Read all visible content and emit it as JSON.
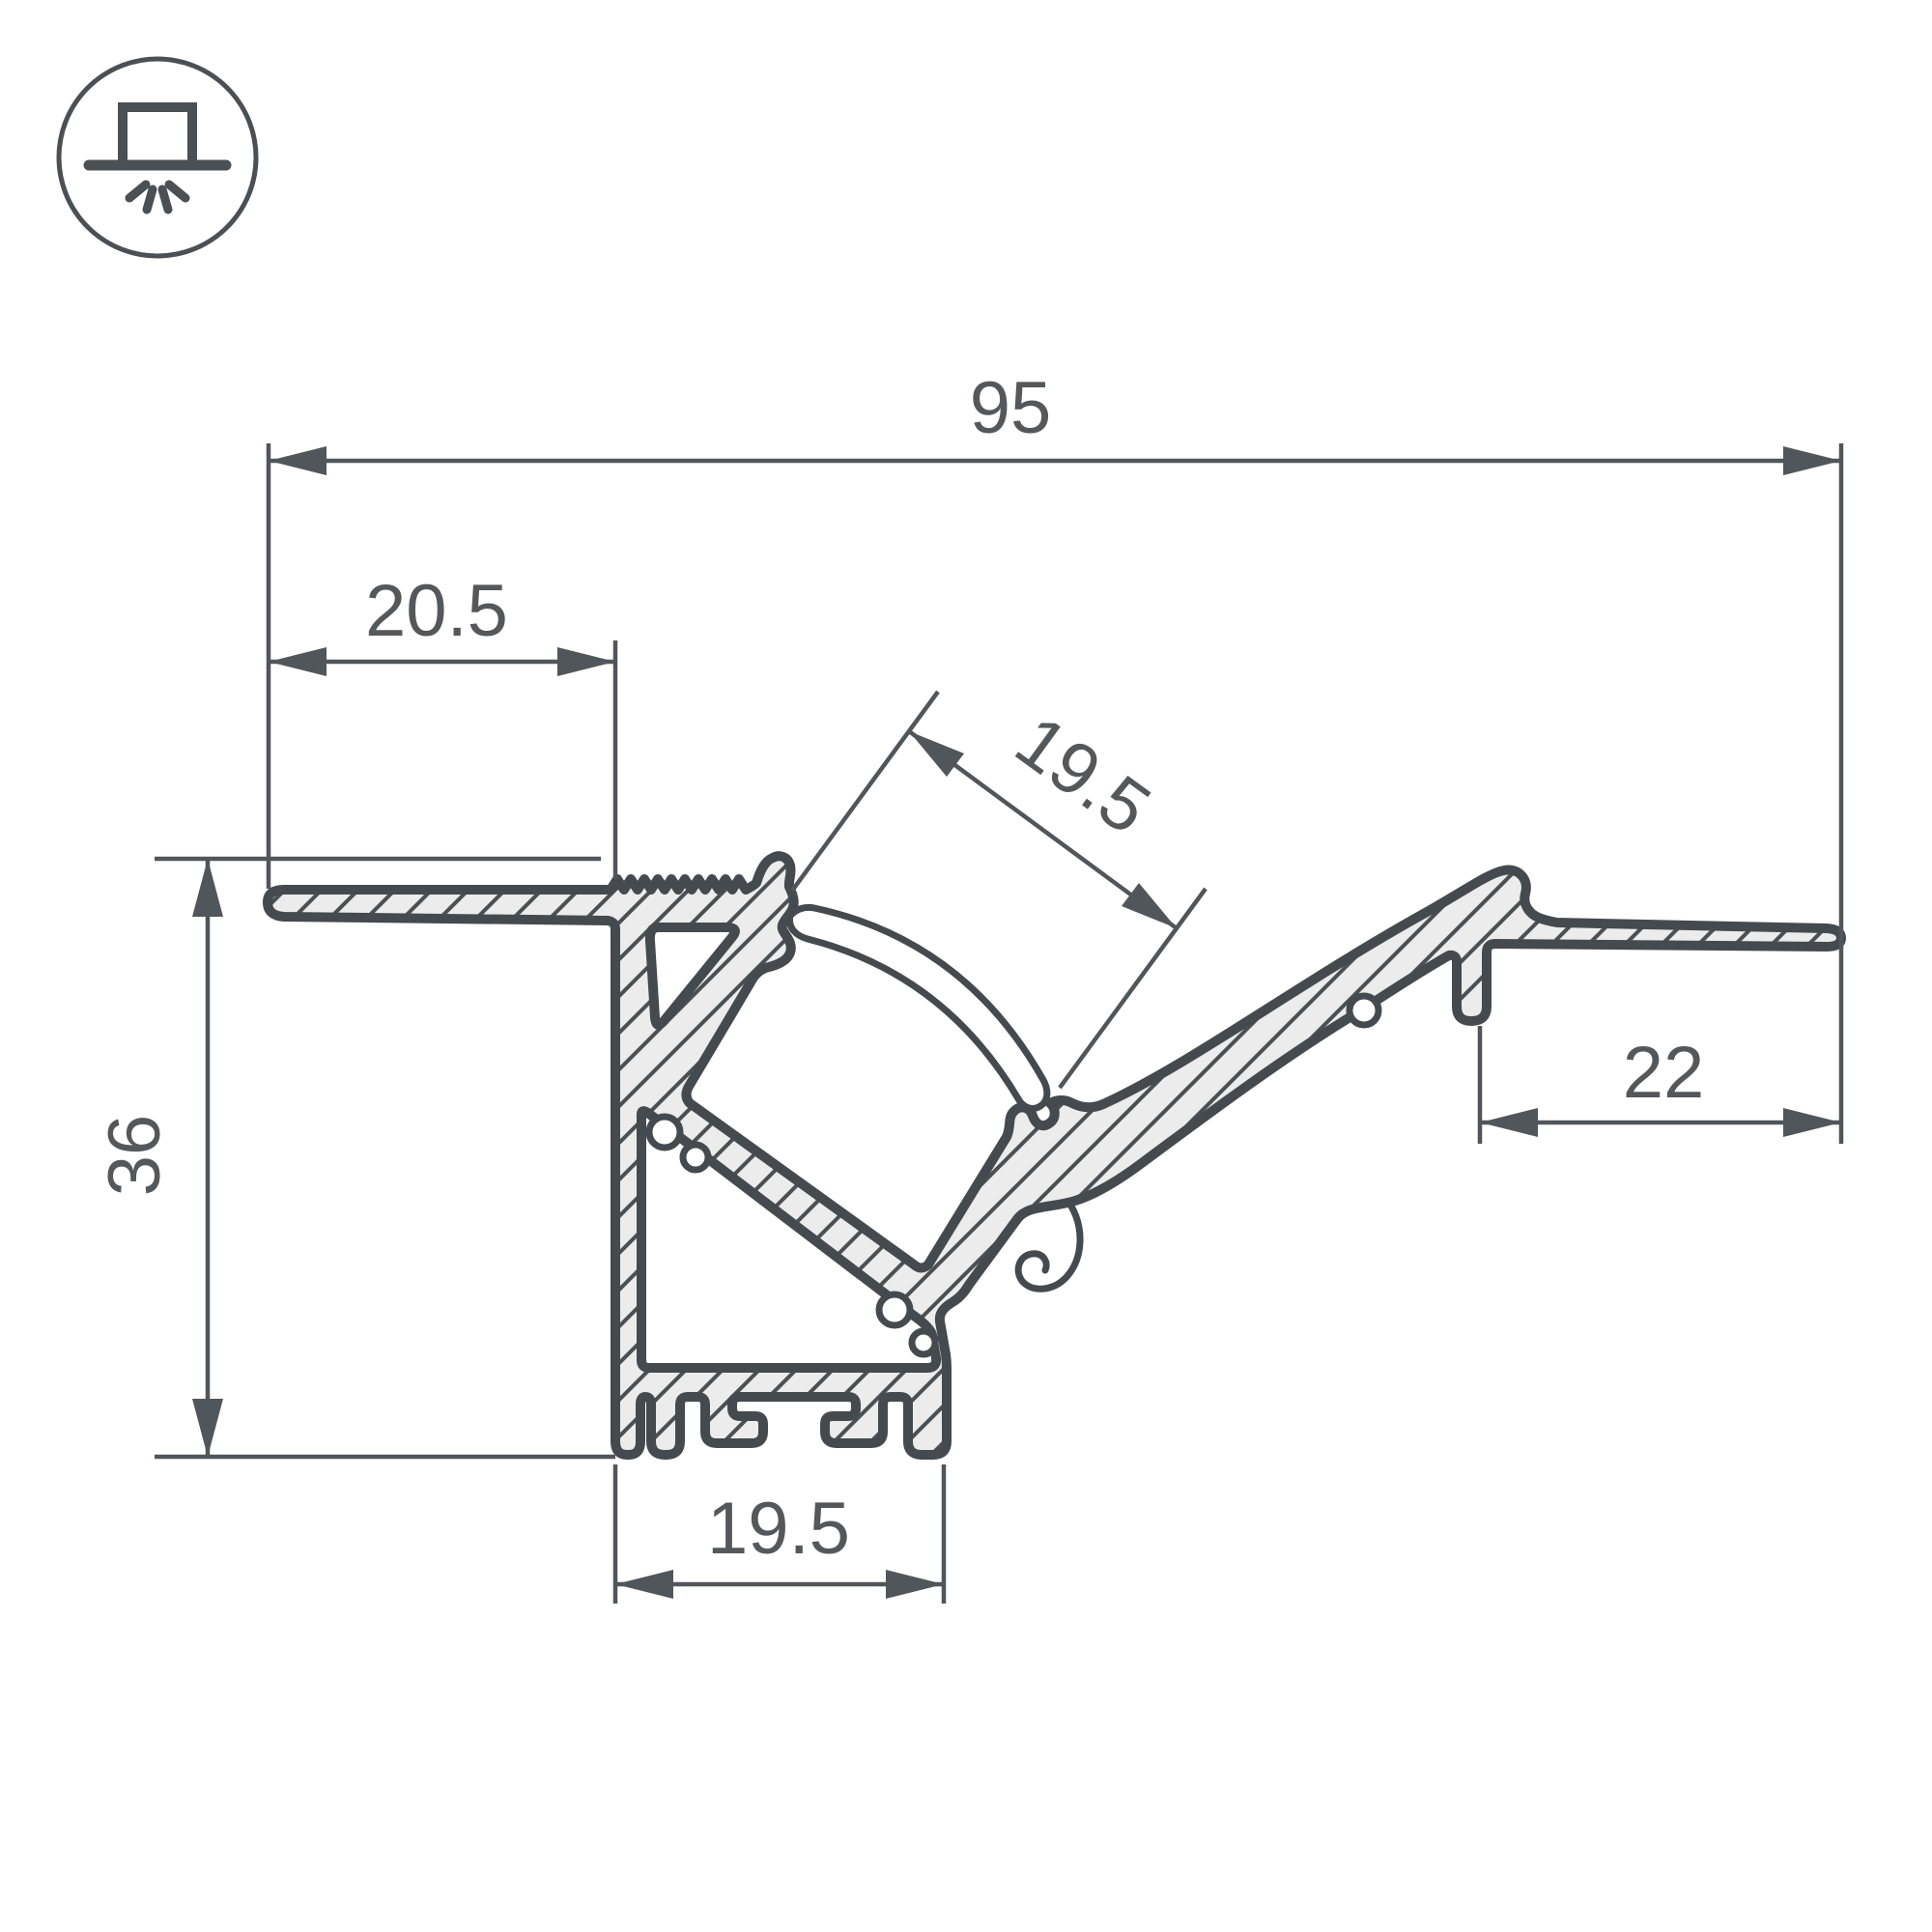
{
  "icon": {
    "name": "recessed-light-icon"
  },
  "drawing": {
    "type": "profile-cross-section"
  },
  "dimensions": {
    "overall_width": {
      "value": "95",
      "orientation": "horizontal-top"
    },
    "left_flange_width": {
      "value": "20.5",
      "orientation": "horizontal"
    },
    "channel_opening": {
      "value": "19.5",
      "orientation": "angled-36deg"
    },
    "right_flange_width": {
      "value": "22",
      "orientation": "horizontal"
    },
    "overall_height": {
      "value": "36",
      "orientation": "vertical"
    },
    "base_width": {
      "value": "19.5",
      "orientation": "horizontal-bottom"
    }
  },
  "colors": {
    "background": "#ffffff",
    "outline": "#454a4e",
    "dimension_line": "#51565a",
    "text": "#54585b",
    "aluminum_fill": "#ebeceb"
  }
}
